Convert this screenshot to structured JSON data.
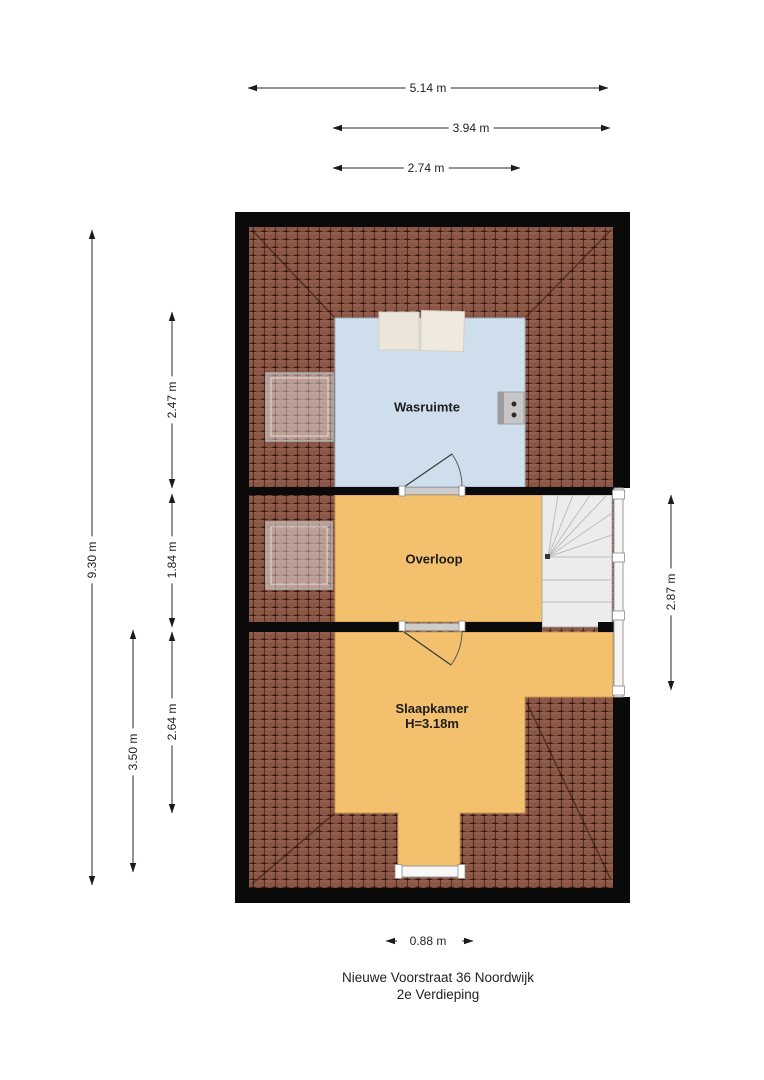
{
  "plan": {
    "title_line1": "Nieuwe Voorstraat 36 Noordwijk",
    "title_line2": "2e Verdieping",
    "rooms": {
      "wasruimte": "Wasruimte",
      "overloop": "Overloop",
      "slaapkamer": "Slaapkamer",
      "slaapkamer_height": "H=3.18m"
    },
    "dimensions": {
      "width_total": "5.14 m",
      "width_upper": "3.94 m",
      "width_wasruimte": "2.74 m",
      "height_total": "9.30 m",
      "height_wasruimte": "2.47 m",
      "height_overloop": "1.84 m",
      "height_slaapkamer": "2.64 m",
      "height_lower": "3.50 m",
      "height_stairwell": "2.87 m",
      "width_dormer": "0.88 m"
    },
    "colors": {
      "wall": "#0a0a0a",
      "roof_tile": "#8b5645",
      "roof_grout": "#2f150c",
      "room_cold": "#cfdeec",
      "room_warm": "#f3c06e",
      "stairs": "#ececec",
      "dimension": "#2a2a2a"
    }
  }
}
